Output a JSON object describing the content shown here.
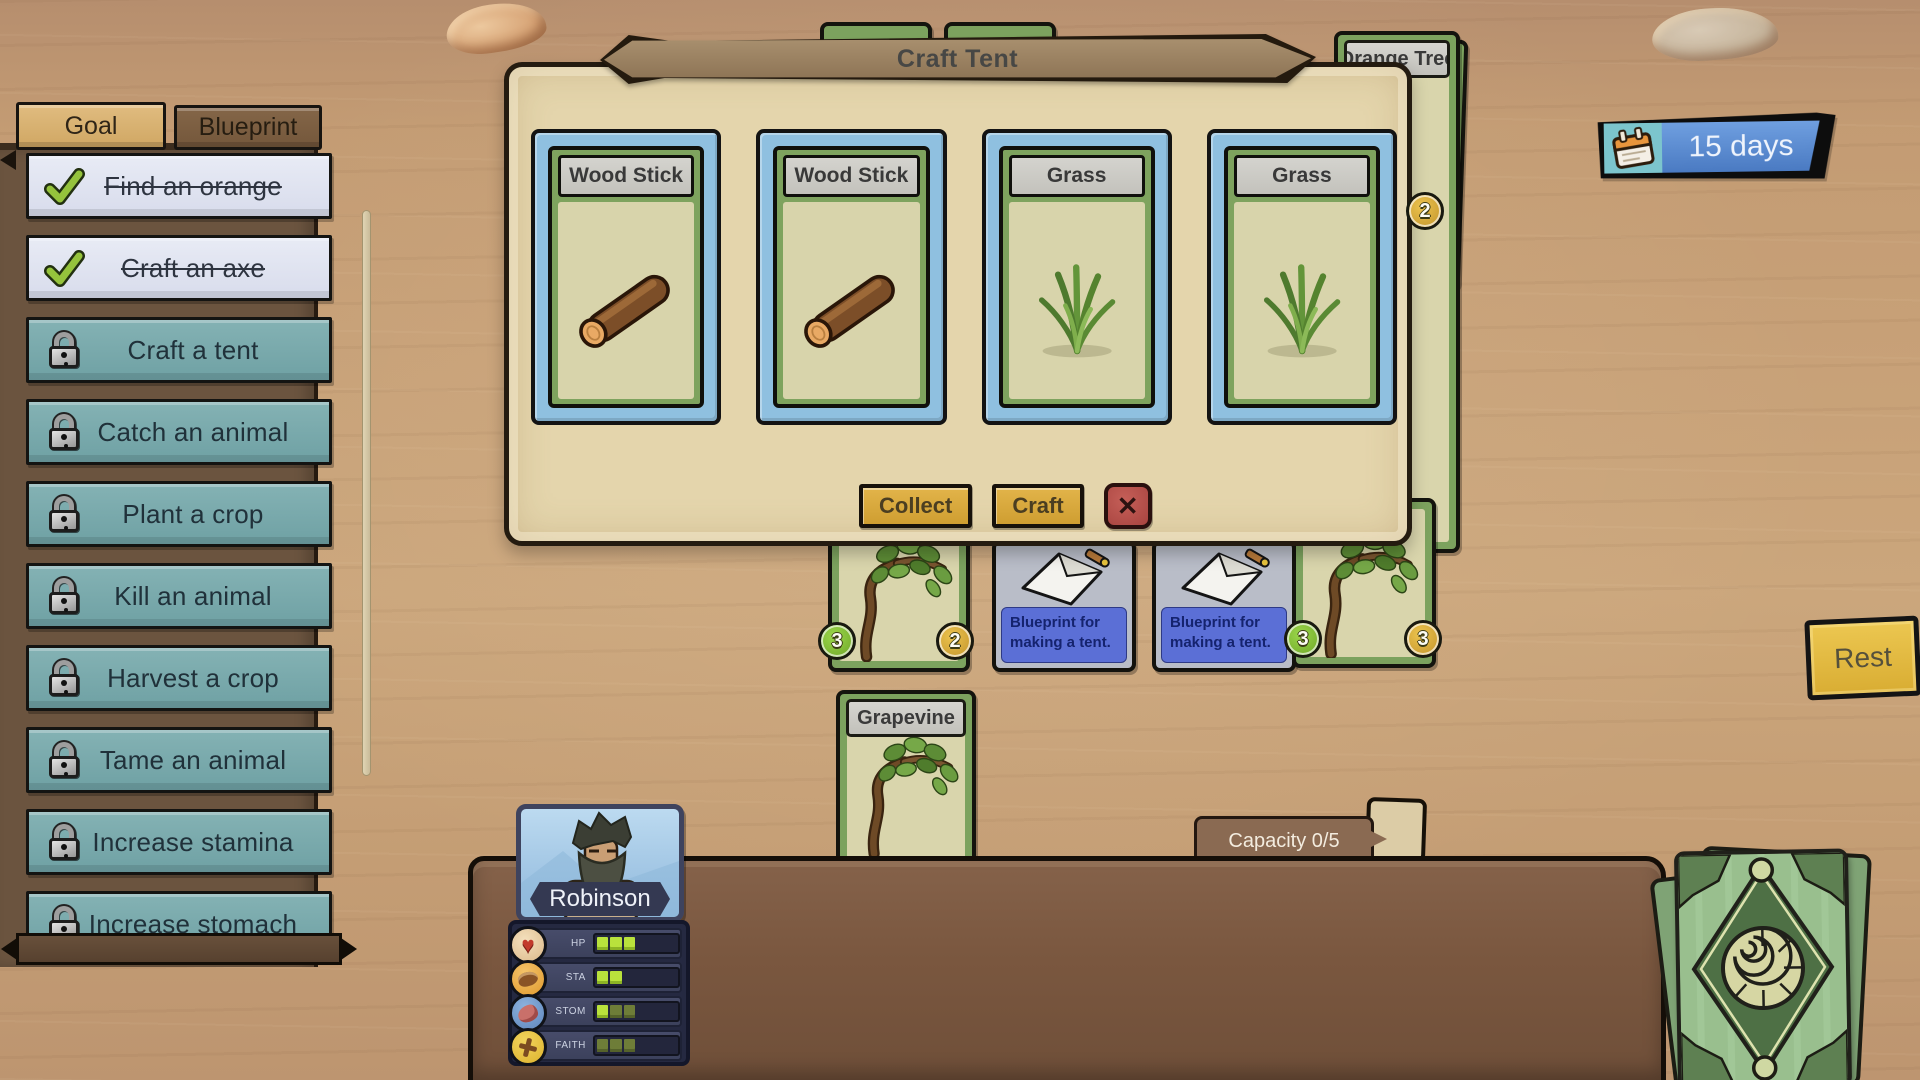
{
  "hud": {
    "day_counter": "15 days",
    "rest_button": "Rest",
    "capacity": "Capacity 0/5"
  },
  "goal_panel": {
    "tabs": [
      {
        "label": "Goal",
        "active": true
      },
      {
        "label": "Blueprint",
        "active": false
      }
    ],
    "items": [
      {
        "label": "Find an orange",
        "status": "done"
      },
      {
        "label": "Craft an axe",
        "status": "done"
      },
      {
        "label": "Craft a tent",
        "status": "locked"
      },
      {
        "label": "Catch an animal",
        "status": "locked"
      },
      {
        "label": "Plant a crop",
        "status": "locked"
      },
      {
        "label": "Kill an animal",
        "status": "locked"
      },
      {
        "label": "Harvest a crop",
        "status": "locked"
      },
      {
        "label": "Tame an animal",
        "status": "locked"
      },
      {
        "label": "Increase stamina",
        "status": "locked"
      },
      {
        "label": "Increase stomach",
        "status": "locked"
      }
    ]
  },
  "craft_modal": {
    "title": "Craft Tent",
    "collect_button": "Collect",
    "craft_button": "Craft",
    "close_icon": "✕",
    "slots": [
      {
        "name": "Wood Stick",
        "art": "wood-stick"
      },
      {
        "name": "Wood Stick",
        "art": "wood-stick"
      },
      {
        "name": "Grass",
        "art": "grass"
      },
      {
        "name": "Grass",
        "art": "grass"
      }
    ]
  },
  "table_cards": {
    "orange_tree": {
      "title": "Orange Tree",
      "badge": "2"
    },
    "grapevine_left": {
      "badge_left": "3",
      "badge_right": "2"
    },
    "grapevine_right": {
      "badge_left": "3",
      "badge_right": "3"
    },
    "grapevine_center": {
      "title": "Grapevine"
    },
    "blueprints": [
      {
        "text": "Blueprint for making a tent."
      },
      {
        "text": "Blueprint for making a tent."
      }
    ]
  },
  "character": {
    "name": "Robinson",
    "stats": [
      {
        "label": "HP",
        "icon": "heart-icon",
        "bright": 3,
        "dim": 0,
        "slots": 6
      },
      {
        "label": "STA",
        "icon": "stamina-icon",
        "bright": 2,
        "dim": 0,
        "slots": 6
      },
      {
        "label": "STOM",
        "icon": "stomach-icon",
        "bright": 1,
        "dim": 2,
        "slots": 6
      },
      {
        "label": "FAITH",
        "icon": "cross-icon",
        "bright": 0,
        "dim": 3,
        "slots": 6
      }
    ]
  },
  "colors": {
    "locked_goal": "#74a6a9",
    "done_goal": "#dfe3f0",
    "modal_bg": "#e4d5ac",
    "slot_blue": "#8fc0e0",
    "card_green": "#7ea35e",
    "gold_button": "#d8a83a",
    "close_red": "#a84440",
    "day_blue": "#4a7ac2",
    "blueprint_blue": "#5b6fd6",
    "stat_bright": "#b9e23c",
    "stat_dim": "#6e7d38"
  }
}
